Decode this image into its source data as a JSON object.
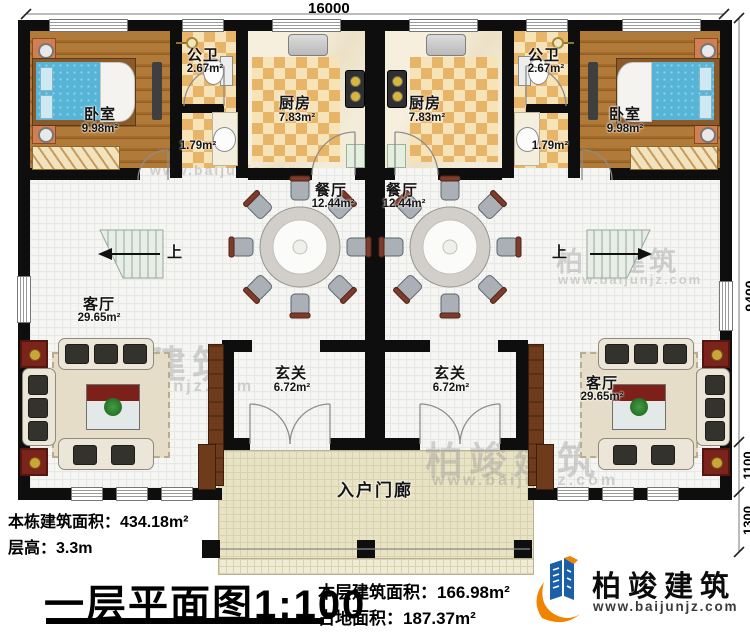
{
  "dimensions": {
    "top": "16000",
    "right_depth": "9400",
    "right_foyer": "1100",
    "right_porch": "1300"
  },
  "rooms": {
    "bedroom": {
      "label": "卧室",
      "area": "9.98m²"
    },
    "bath": {
      "label": "公卫",
      "area": "2.67m²"
    },
    "wash": {
      "area": "1.79m²"
    },
    "kitchen": {
      "label": "厨房",
      "area": "7.83m²"
    },
    "dining": {
      "label": "餐厅",
      "area": "12.44m²"
    },
    "living": {
      "label": "客厅",
      "area": "29.65m²"
    },
    "foyer": {
      "label": "玄关",
      "area": "6.72m²"
    },
    "porch": {
      "label": "入户门廊"
    },
    "stairs": {
      "up_label": "上"
    }
  },
  "info": {
    "building_area_label": "本栋建筑面积：",
    "building_area_value": "434.18m²",
    "floor_height_label": "层高：",
    "floor_height_value": "3.3m",
    "plan_title": "一层平面图",
    "plan_scale": "1:100",
    "floor_area_label": "本层建筑面积：",
    "floor_area_value": "166.98m²",
    "land_area_label": "占地面积：",
    "land_area_value": "187.37m²"
  },
  "brand": {
    "name": "柏竣建筑",
    "website": "www.baijunjz.com"
  },
  "watermark": {
    "text": "柏竣建筑",
    "site": "www.baijunjz.com"
  },
  "colors": {
    "wall": "#0e0e0e",
    "checker_light": "#f6e3b8",
    "checker_dark": "#e8b468",
    "wood": "#a06a2c",
    "brand_blue": "#1b5fa8",
    "brand_orange": "#f08300"
  }
}
